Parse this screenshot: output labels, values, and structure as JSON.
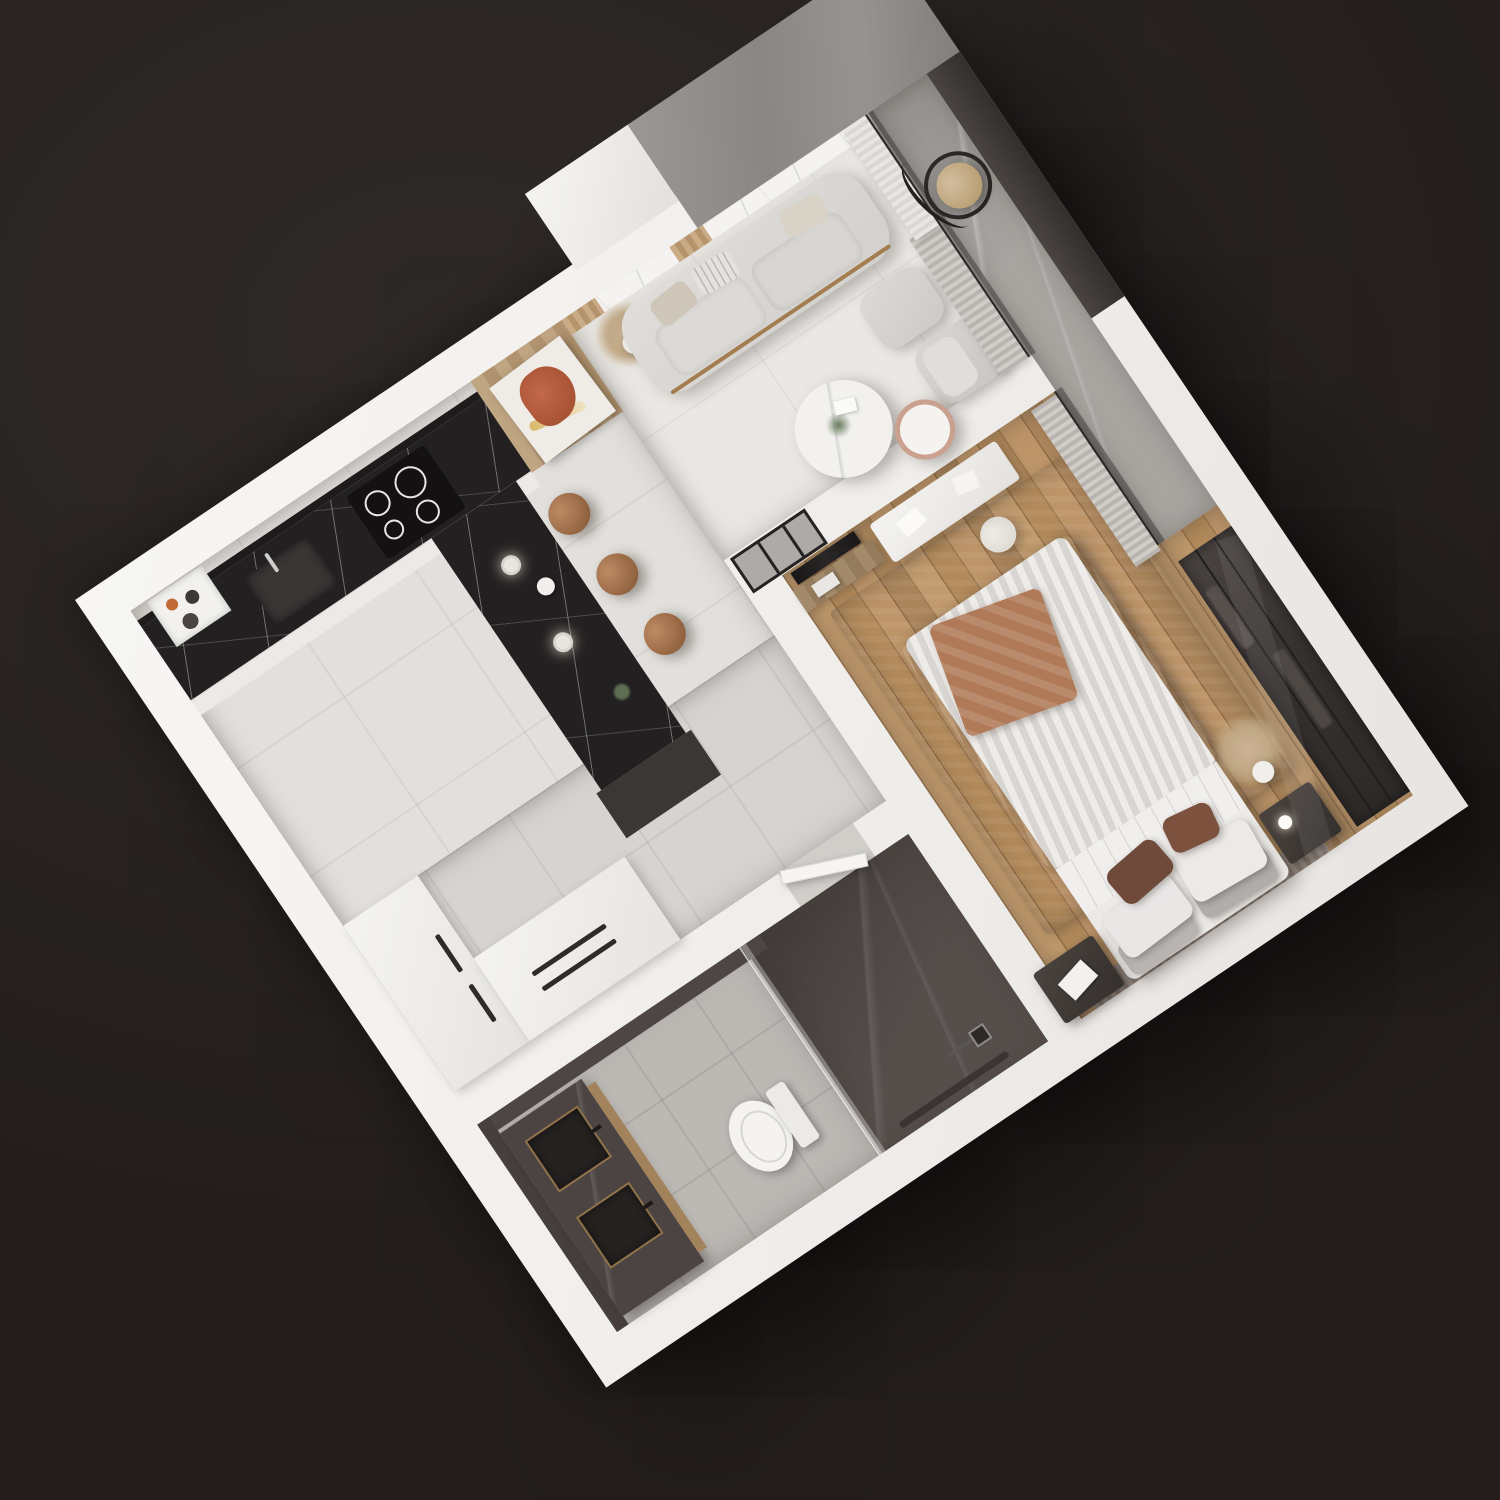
{
  "scene": {
    "type": "3d-isometric-floor-plan-render",
    "subject": "one-bedroom apartment cutaway top view",
    "background_color": "#262120",
    "plan_rotation_deg": -34,
    "wall_color": "#f2f1ef"
  },
  "palette": {
    "background": "#262120",
    "walls_cut": "#f4f3f1",
    "black_marble": "#232021",
    "white_marble": "#f4f3f1",
    "wood_floor": "#b58e61",
    "wood_cabinet": "#b89b79",
    "concrete": "#a8a4a0",
    "rug_gray": "#857c7e",
    "curtain_gray": "#c4bfba",
    "curtain_sheer": "#e3e1dd",
    "stool_leather": "#a87352",
    "terracotta_accent": "#b07a58",
    "dark_glass": "#363130",
    "bathroom_dark_marble": "#564e4b",
    "brass_trim": "#caa05f"
  },
  "rooms": {
    "kitchen": {
      "name": "Kitchen",
      "floor": "light gray tile",
      "items": [
        "white upper cabinets",
        "black marble L-counter",
        "induction hob",
        "undermount sink",
        "open shelf with jars",
        "tall wood unit",
        "leaning abstract artwork",
        "marble bar peninsula",
        "three leather bar stools",
        "two glass pendant lights"
      ]
    },
    "hallway": {
      "name": "Hallway",
      "floor": "gray concrete tile",
      "items": [
        "tall white wardrobe",
        "low white cabinet with black handles",
        "bathroom door"
      ]
    },
    "living_room": {
      "name": "Living room",
      "floor": "light porcelain tile",
      "items": [
        "white marble TV wall with wood slats",
        "pampas plant in white pot",
        "light gray sofa with cushions",
        "ottoman",
        "lounge armchair",
        "round marble coffee table",
        "small blush side table",
        "gray curtain",
        "sheer curtain",
        "glass partition to balcony"
      ]
    },
    "balcony": {
      "name": "Balcony",
      "floor": "gray concrete / stone",
      "items": [
        "hanging egg chair with black stand",
        "concrete parapet wall",
        "dark glass balustrade"
      ]
    },
    "bedroom": {
      "name": "Bedroom",
      "floor": "oak plank wood",
      "items": [
        "black framed glass door",
        "wall TV with wood console",
        "white desk with papers",
        "round cream stool",
        "gray area rug",
        "double bed with gray duvet",
        "white and brown pillows",
        "terracotta throw",
        "fluted headboard panel",
        "two dark nightstands",
        "bedside lamp",
        "pampas vase",
        "pleated gray curtain",
        "glass wall to loggia",
        "dark glass sliding wardrobe"
      ]
    },
    "bathroom": {
      "name": "Bathroom",
      "floor": "gray tile and dark marble",
      "items": [
        "dark marble double vanity with brass lit basins",
        "wood trim",
        "white toilet",
        "glass shower screen",
        "black shower column",
        "linear drain",
        "dark marble shower zone"
      ]
    }
  }
}
